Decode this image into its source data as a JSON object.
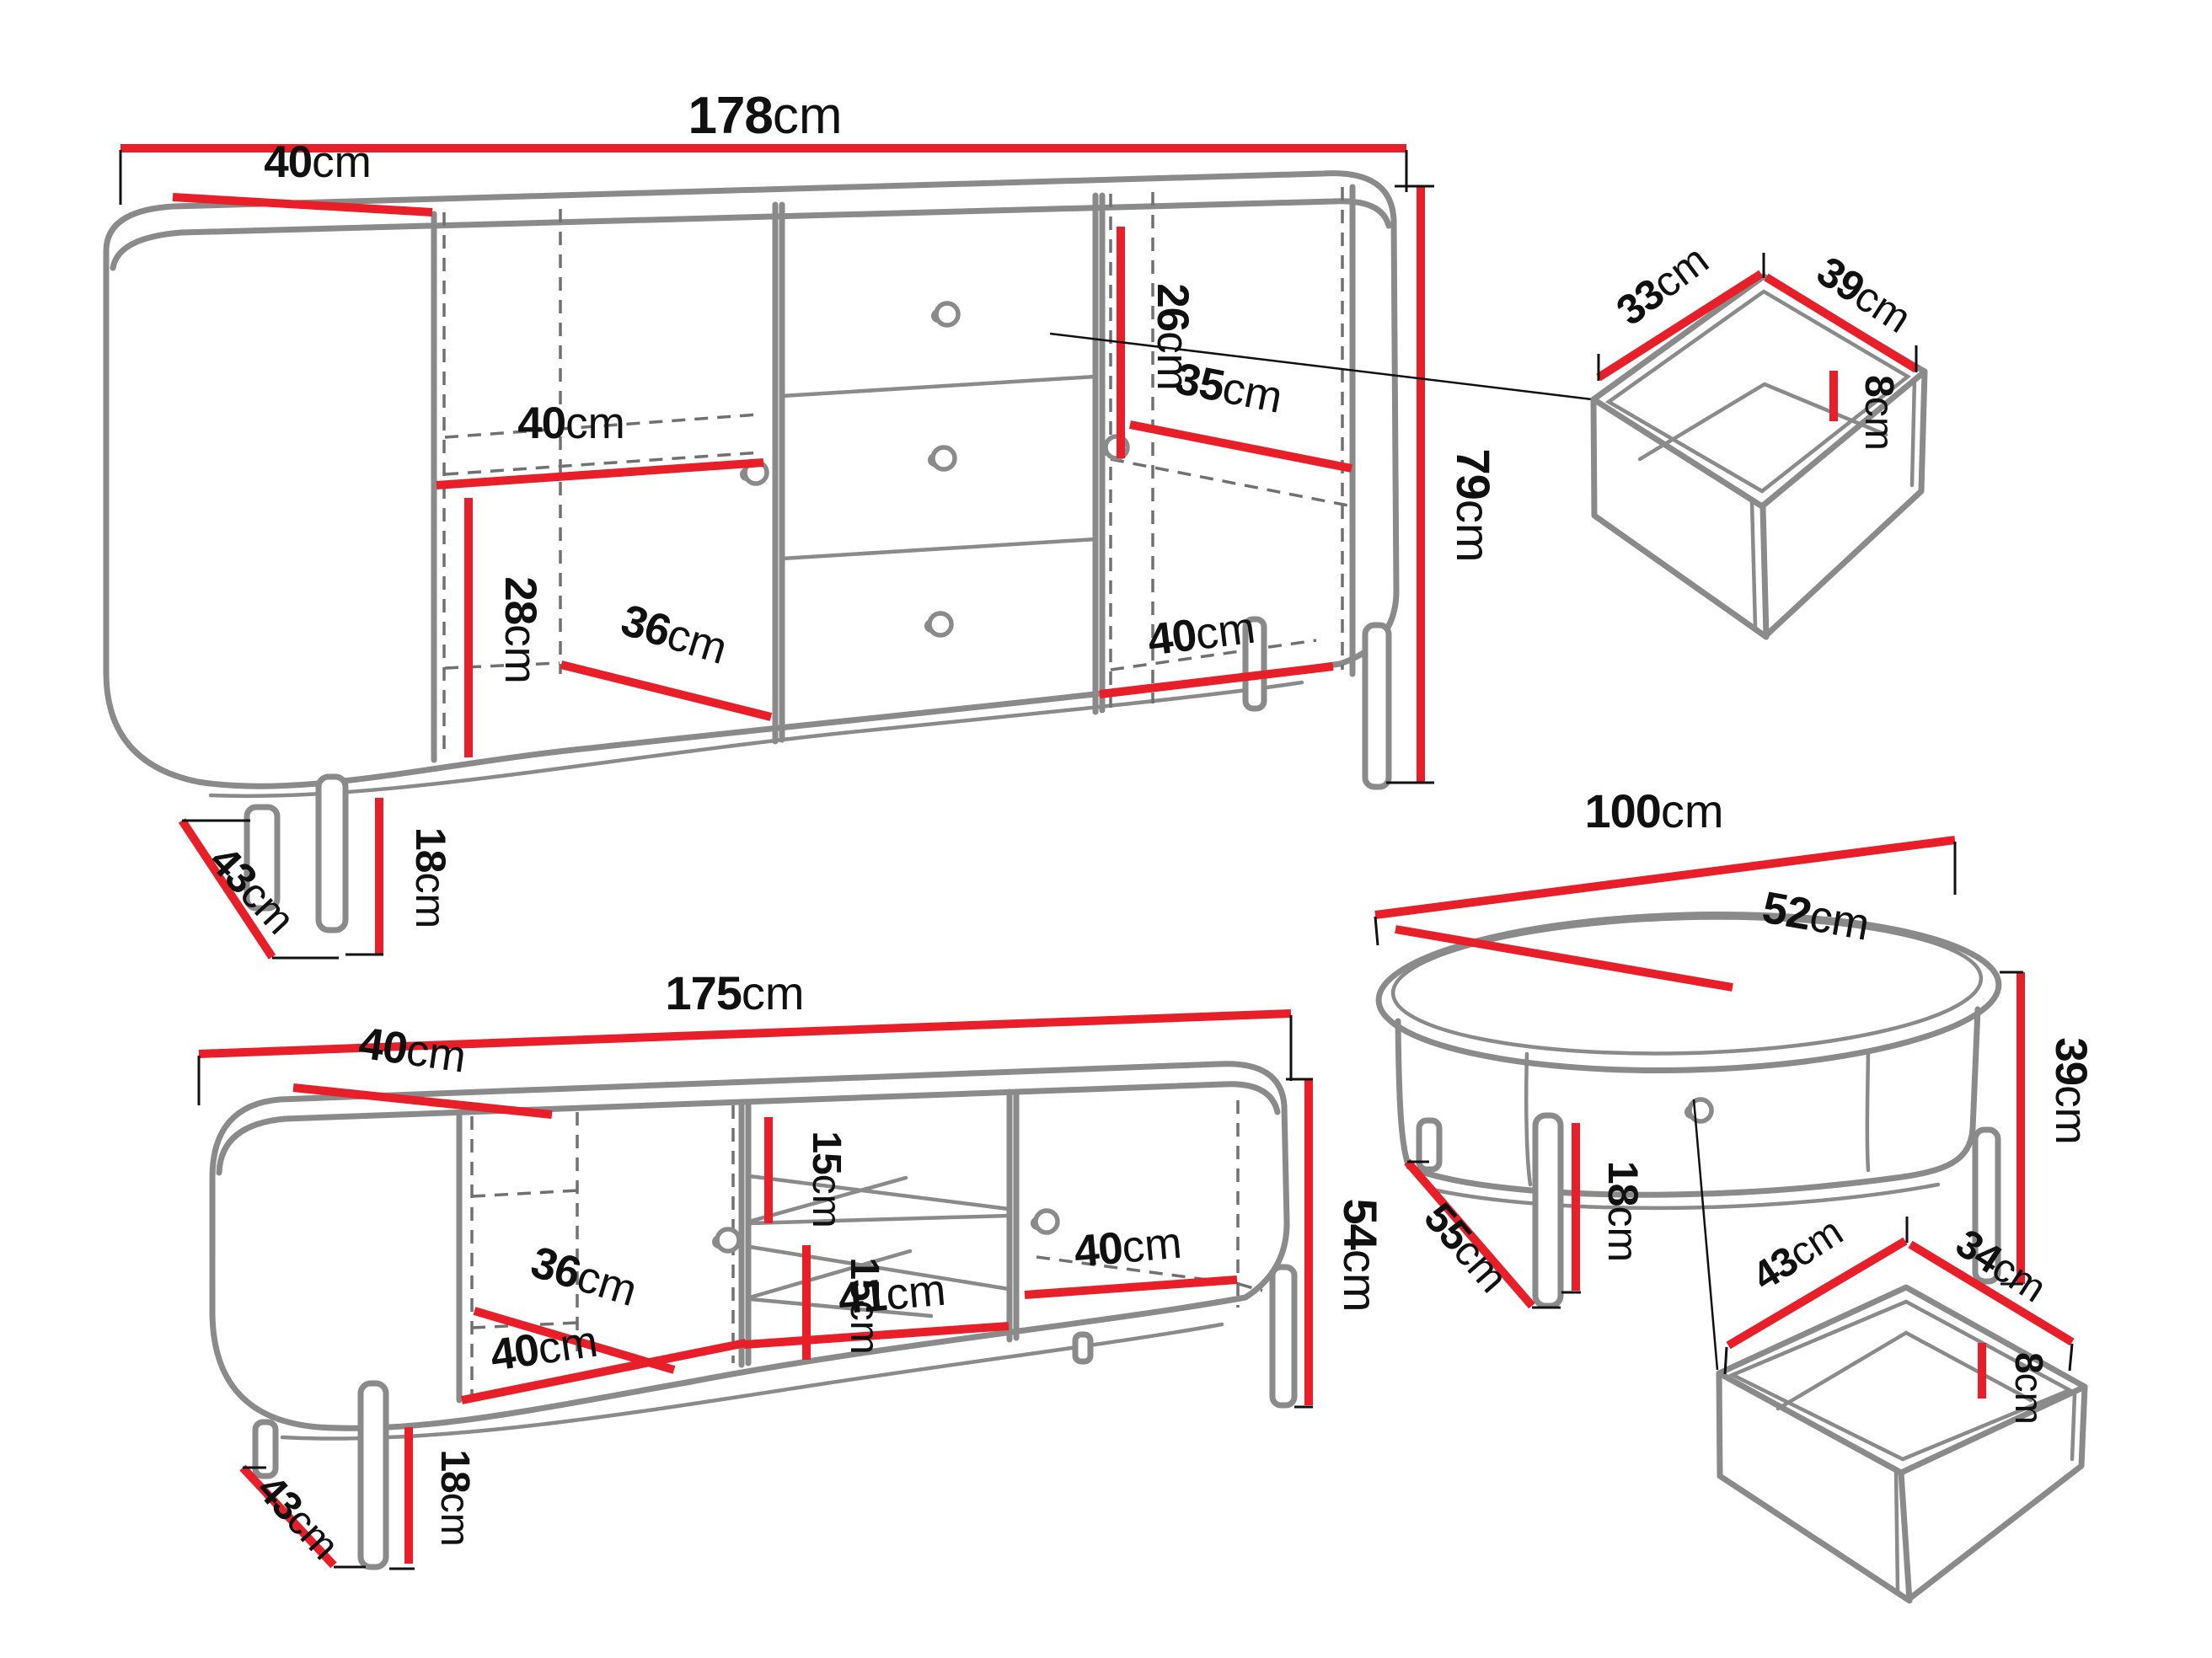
{
  "colors": {
    "dimension_line": "#e81f28",
    "outline": "#8a8a8a",
    "text": "#101010",
    "background": "#ffffff",
    "hidden_edge": "#707070"
  },
  "sideboard": {
    "width": {
      "value": "178",
      "unit": "cm"
    },
    "depth": {
      "value": "40",
      "unit": "cm"
    },
    "shelf_width": {
      "value": "40",
      "unit": "cm"
    },
    "lower_section_height": {
      "value": "28",
      "unit": "cm"
    },
    "bottom_depth": {
      "value": "36",
      "unit": "cm"
    },
    "right_top_height": {
      "value": "26",
      "unit": "cm"
    },
    "right_shelf_width": {
      "value": "35",
      "unit": "cm"
    },
    "right_bottom_width": {
      "value": "40",
      "unit": "cm"
    },
    "height": {
      "value": "79",
      "unit": "cm"
    },
    "leg_height": {
      "value": "18",
      "unit": "cm"
    },
    "leg_depth": {
      "value": "43",
      "unit": "cm"
    }
  },
  "drawer_large": {
    "width": {
      "value": "33",
      "unit": "cm"
    },
    "depth": {
      "value": "39",
      "unit": "cm"
    },
    "inner_height": {
      "value": "8",
      "unit": "cm"
    }
  },
  "coffee_table": {
    "length": {
      "value": "100",
      "unit": "cm"
    },
    "width": {
      "value": "52",
      "unit": "cm"
    },
    "height": {
      "value": "39",
      "unit": "cm"
    },
    "leg_depth": {
      "value": "55",
      "unit": "cm"
    },
    "leg_height": {
      "value": "18",
      "unit": "cm"
    }
  },
  "tv_stand": {
    "width": {
      "value": "175",
      "unit": "cm"
    },
    "depth": {
      "value": "40",
      "unit": "cm"
    },
    "upper_shelf_gap": {
      "value": "15",
      "unit": "cm"
    },
    "lower_shelf_gap": {
      "value": "15",
      "unit": "cm"
    },
    "open_section_width": {
      "value": "41",
      "unit": "cm"
    },
    "left_door_bottom_width": {
      "value": "40",
      "unit": "cm"
    },
    "left_bottom_depth": {
      "value": "36",
      "unit": "cm"
    },
    "right_door_width": {
      "value": "40",
      "unit": "cm"
    },
    "height": {
      "value": "54",
      "unit": "cm"
    },
    "leg_height": {
      "value": "18",
      "unit": "cm"
    },
    "leg_depth": {
      "value": "43",
      "unit": "cm"
    }
  },
  "drawer_small": {
    "width": {
      "value": "43",
      "unit": "cm"
    },
    "depth": {
      "value": "34",
      "unit": "cm"
    },
    "inner_height": {
      "value": "8",
      "unit": "cm"
    }
  }
}
